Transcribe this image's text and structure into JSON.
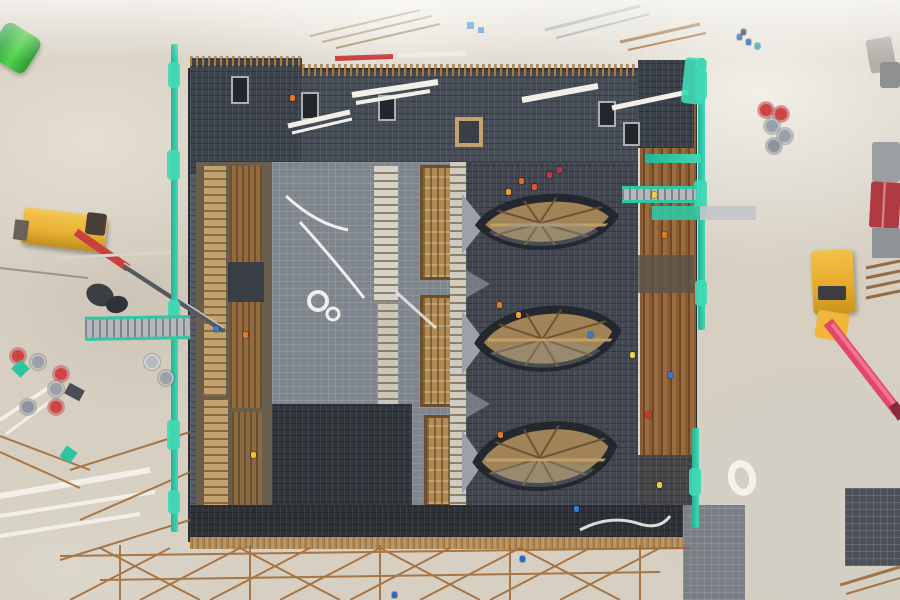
{
  "scene": {
    "title": "Aerial drone photo of a construction site",
    "description": "Top-down view of a large rectangular foundation pit with dark rebar decks, timber formwork walls, three eye-shaped concrete intake structures with funnel channels, teal safety fencing, cranes and scattered materials on pale sandy ground.",
    "view": "top-down aerial",
    "lighting": "hazy daylight, washed-out upper area"
  },
  "palette": {
    "sand": "#d6cfc2",
    "sand_light": "#efede6",
    "pit_dark": "#3e444c",
    "pit_gray": "#7e858d",
    "pit_deep": "#2d3136",
    "rebar_rust": "#8a5c34",
    "formwork_tan": "#c2a26e",
    "formwork_tan_dark": "#a08457",
    "timber_brown": "#936b3f",
    "fence_teal": "#2fc7a4",
    "crane_yellow": "#e2a52c",
    "boom_red": "#cc3f3f",
    "boom_pink": "#e0476a",
    "machine_green": "#46c13f",
    "barrel_red": "#cc4444",
    "barrel_gray": "#9aa0a8",
    "concrete_light": "#9ba1a6",
    "white_lumber": "#f1efe8",
    "truck_maroon": "#b03a42"
  },
  "objects": {
    "foundation_pit": {
      "label": "rectangular foundation pit with rebar mesh decks"
    },
    "intake_eyes": {
      "label": "eye-shaped intake structures with wooden falsework",
      "count": 3
    },
    "formwork_towers": {
      "label": "timber formwork towers",
      "count": 3
    },
    "green_machine": {
      "label": "green compactor at top-left"
    },
    "left_crane": {
      "label": "yellow mobile crane with red boom and lattice jib"
    },
    "right_crane": {
      "label": "yellow truck crane with pink boom at right"
    },
    "dump_truck": {
      "label": "maroon truck at far right edge"
    },
    "fences": {
      "label": "teal mesh safety fencing",
      "segments": 6
    },
    "bridges": {
      "label": "temporary walkway bridges",
      "count": 2
    },
    "barrel_clusters": {
      "label": "red and gray drums",
      "clusters": 2
    },
    "lumber": {
      "label": "white lumber planks and beams"
    },
    "hose_ring": {
      "label": "white coiled hose near right fence"
    },
    "scaffolding": {
      "label": "rust-brown scaffold grid along bottom edge"
    }
  },
  "workers": {
    "approx_count": 26,
    "helmet_colors": [
      "orange",
      "red",
      "yellow",
      "blue",
      "cyan"
    ]
  }
}
